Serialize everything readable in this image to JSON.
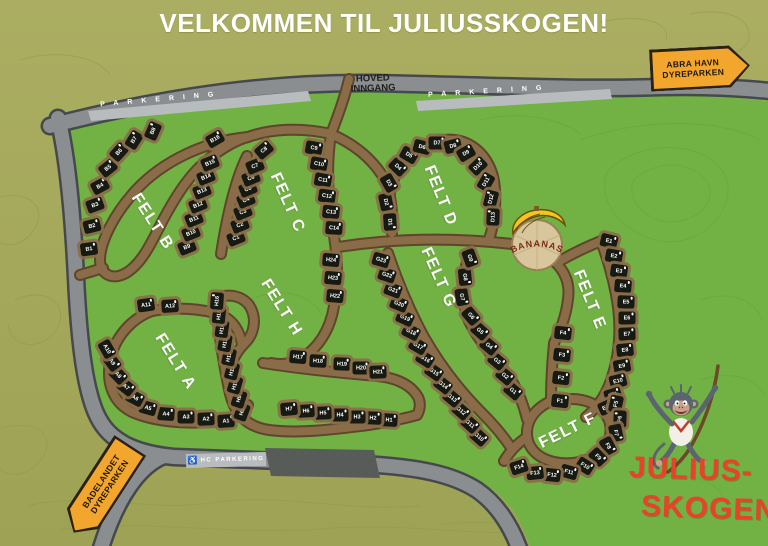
{
  "title": "VELKOMMEN TIL JULIUSSKOGEN!",
  "entrance": {
    "line1": "HOVED",
    "line2": "INNGANG"
  },
  "parking": {
    "left": "PARKERING",
    "right": "PARKERING",
    "hc": "HC PARKERING",
    "wheelchair_icon": "♿"
  },
  "landmarks": {
    "bananas": "BANANAS"
  },
  "signs": {
    "abra": {
      "line1": "ABRA HAVN",
      "line2": "DYREPARKEN"
    },
    "badelandet": {
      "line1": "BADELANDET",
      "line2": "DYREPARKEN"
    }
  },
  "logo": {
    "line1": "JULIUS-",
    "line2": "SKOGEN"
  },
  "colors": {
    "background_olive": "#a6a95c",
    "grass_green": "#72b144",
    "road_gray": "#8b8e90",
    "path_brown": "#8a6c49",
    "cabin_black": "#171a12",
    "sign_yellow": "#f3a62d",
    "logo_red": "#e8432a",
    "parking_light": "#b9bcbe"
  },
  "map": {
    "felts": [
      {
        "id": "a",
        "label": "FELT A",
        "lx": 175,
        "ly": 362,
        "lr": 58,
        "cabins": [
          [
            "A1",
            226,
            421,
            -4
          ],
          [
            "A2",
            206,
            419,
            -2
          ],
          [
            "A3",
            186,
            417,
            0
          ],
          [
            "A4",
            166,
            414,
            4
          ],
          [
            "A5",
            148,
            408,
            16
          ],
          [
            "A6",
            135,
            398,
            28
          ],
          [
            "A7",
            126,
            387,
            38
          ],
          [
            "A8",
            118,
            375,
            46
          ],
          [
            "A9",
            112,
            362,
            54
          ],
          [
            "A10",
            107,
            349,
            60
          ],
          [
            "A11",
            146,
            305,
            -8
          ],
          [
            "A12",
            170,
            306,
            -4
          ]
        ]
      },
      {
        "id": "b",
        "label": "FELT B",
        "lx": 152,
        "ly": 222,
        "lr": 57,
        "cabins": [
          [
            "B1",
            89,
            249,
            -8
          ],
          [
            "B2",
            92,
            226,
            -14
          ],
          [
            "B3",
            95,
            205,
            -20
          ],
          [
            "B4",
            100,
            186,
            -28
          ],
          [
            "B5",
            108,
            168,
            -38
          ],
          [
            "B6",
            119,
            152,
            -48
          ],
          [
            "B7",
            134,
            140,
            -58
          ],
          [
            "B8",
            153,
            131,
            -66
          ],
          [
            "B9",
            187,
            247,
            -22
          ],
          [
            "B10",
            191,
            233,
            -22
          ],
          [
            "B11",
            194,
            219,
            -22
          ],
          [
            "B12",
            198,
            205,
            -22
          ],
          [
            "B13",
            202,
            191,
            -22
          ],
          [
            "B14",
            206,
            177,
            -22
          ],
          [
            "B15",
            210,
            163,
            -22
          ],
          [
            "B16",
            215,
            139,
            -30
          ]
        ]
      },
      {
        "id": "c",
        "label": "FELT C",
        "lx": 287,
        "ly": 203,
        "lr": 66,
        "cabins": [
          [
            "C1",
            236,
            238,
            -22
          ],
          [
            "C2",
            240,
            225,
            -22
          ],
          [
            "C3",
            243,
            212,
            -22
          ],
          [
            "C4",
            246,
            200,
            -22
          ],
          [
            "C5",
            248,
            189,
            -22
          ],
          [
            "C6",
            251,
            178,
            -22
          ],
          [
            "C7",
            255,
            166,
            -22
          ],
          [
            "C8",
            264,
            150,
            -40
          ],
          [
            "C9",
            314,
            148,
            10
          ],
          [
            "C10",
            319,
            164,
            10
          ],
          [
            "C11",
            323,
            180,
            10
          ],
          [
            "C12",
            327,
            196,
            8
          ],
          [
            "C13",
            331,
            212,
            6
          ],
          [
            "C14",
            334,
            228,
            4
          ]
        ]
      },
      {
        "id": "d",
        "label": "FELT D",
        "lx": 440,
        "ly": 196,
        "lr": 68,
        "cabins": [
          [
            "D1",
            390,
            222,
            86
          ],
          [
            "D2",
            386,
            202,
            78
          ],
          [
            "D3",
            389,
            183,
            60
          ],
          [
            "D4",
            398,
            167,
            44
          ],
          [
            "D5",
            409,
            155,
            30
          ],
          [
            "D6",
            422,
            147,
            14
          ],
          [
            "D7",
            437,
            143,
            0
          ],
          [
            "D8",
            453,
            146,
            -14
          ],
          [
            "D9",
            466,
            153,
            -30
          ],
          [
            "D10",
            478,
            166,
            -44
          ],
          [
            "D11",
            486,
            182,
            -60
          ],
          [
            "D12",
            491,
            199,
            -76
          ],
          [
            "D13",
            493,
            217,
            -88
          ]
        ]
      },
      {
        "id": "e",
        "label": "FELT E",
        "lx": 589,
        "ly": 300,
        "lr": 68,
        "cabins": [
          [
            "E1",
            609,
            241,
            14
          ],
          [
            "E2",
            614,
            256,
            10
          ],
          [
            "E3",
            619,
            271,
            8
          ],
          [
            "E4",
            623,
            286,
            5
          ],
          [
            "E5",
            626,
            302,
            2
          ],
          [
            "E6",
            627,
            318,
            0
          ],
          [
            "E7",
            627,
            334,
            -2
          ],
          [
            "E8",
            625,
            350,
            -6
          ],
          [
            "E9",
            622,
            366,
            -10
          ],
          [
            "E10",
            618,
            381,
            -14
          ],
          [
            "E11",
            613,
            395,
            -18
          ],
          [
            "E12",
            607,
            407,
            -24
          ]
        ]
      },
      {
        "id": "f",
        "label": "FELT F",
        "lx": 568,
        "ly": 431,
        "lr": -26,
        "cabins": [
          [
            "F1",
            560,
            401,
            6
          ],
          [
            "F2",
            561,
            378,
            6
          ],
          [
            "F3",
            562,
            355,
            6
          ],
          [
            "F4",
            563,
            333,
            6
          ],
          [
            "F5",
            616,
            404,
            -78
          ],
          [
            "F6",
            620,
            419,
            -88
          ],
          [
            "F7",
            616,
            433,
            78
          ],
          [
            "F8",
            608,
            446,
            62
          ],
          [
            "F9",
            598,
            457,
            46
          ],
          [
            "F10",
            585,
            466,
            32
          ],
          [
            "F11",
            569,
            472,
            16
          ],
          [
            "F12",
            552,
            475,
            6
          ],
          [
            "F13",
            535,
            473,
            -6
          ],
          [
            "F14",
            519,
            467,
            -18
          ]
        ]
      },
      {
        "id": "g",
        "label": "FELT G",
        "lx": 438,
        "ly": 278,
        "lr": 66,
        "cabins": [
          [
            "G1",
            513,
            391,
            40
          ],
          [
            "G2",
            505,
            376,
            40
          ],
          [
            "G3",
            497,
            361,
            40
          ],
          [
            "G4",
            489,
            346,
            40
          ],
          [
            "G5",
            480,
            331,
            42
          ],
          [
            "G6",
            471,
            316,
            50
          ],
          [
            "G7",
            462,
            297,
            80
          ],
          [
            "G8",
            465,
            277,
            84
          ],
          [
            "G9",
            470,
            258,
            70
          ],
          [
            "G10",
            479,
            437,
            42
          ],
          [
            "G11",
            470,
            424,
            42
          ],
          [
            "G12",
            461,
            411,
            41
          ],
          [
            "G13",
            452,
            398,
            40
          ],
          [
            "G14",
            443,
            385,
            38
          ],
          [
            "G15",
            434,
            372,
            35
          ],
          [
            "G16",
            425,
            359,
            32
          ],
          [
            "G17",
            418,
            346,
            30
          ],
          [
            "G18",
            411,
            332,
            27
          ],
          [
            "G19",
            405,
            318,
            24
          ],
          [
            "G20",
            399,
            304,
            22
          ],
          [
            "G21",
            393,
            290,
            20
          ],
          [
            "G22",
            387,
            275,
            18
          ],
          [
            "G23",
            381,
            260,
            16
          ]
        ]
      },
      {
        "id": "h",
        "label": "FELT H",
        "lx": 281,
        "ly": 308,
        "lr": 58,
        "cabins": [
          [
            "H1",
            389,
            420,
            4
          ],
          [
            "H2",
            373,
            418,
            2
          ],
          [
            "H3",
            357,
            417,
            0
          ],
          [
            "H4",
            340,
            415,
            0
          ],
          [
            "H5",
            323,
            413,
            -2
          ],
          [
            "H6",
            306,
            411,
            -3
          ],
          [
            "H7",
            289,
            409,
            -5
          ],
          [
            "H8",
            242,
            412,
            -70
          ],
          [
            "H9",
            239,
            399,
            -72
          ],
          [
            "H10",
            235,
            385,
            -74
          ],
          [
            "H11",
            232,
            371,
            -76
          ],
          [
            "H12",
            229,
            357,
            -78
          ],
          [
            "H13",
            225,
            343,
            -80
          ],
          [
            "H14",
            222,
            329,
            -82
          ],
          [
            "H15",
            219,
            315,
            -84
          ],
          [
            "H16",
            217,
            301,
            -86
          ],
          [
            "H17",
            298,
            357,
            5
          ],
          [
            "H18",
            318,
            361,
            3
          ],
          [
            "H19",
            342,
            364,
            2
          ],
          [
            "H20",
            361,
            368,
            0
          ],
          [
            "H21",
            378,
            372,
            -2
          ],
          [
            "H22",
            335,
            296,
            5
          ],
          [
            "H23",
            333,
            278,
            5
          ],
          [
            "H24",
            331,
            260,
            5
          ]
        ]
      }
    ]
  }
}
